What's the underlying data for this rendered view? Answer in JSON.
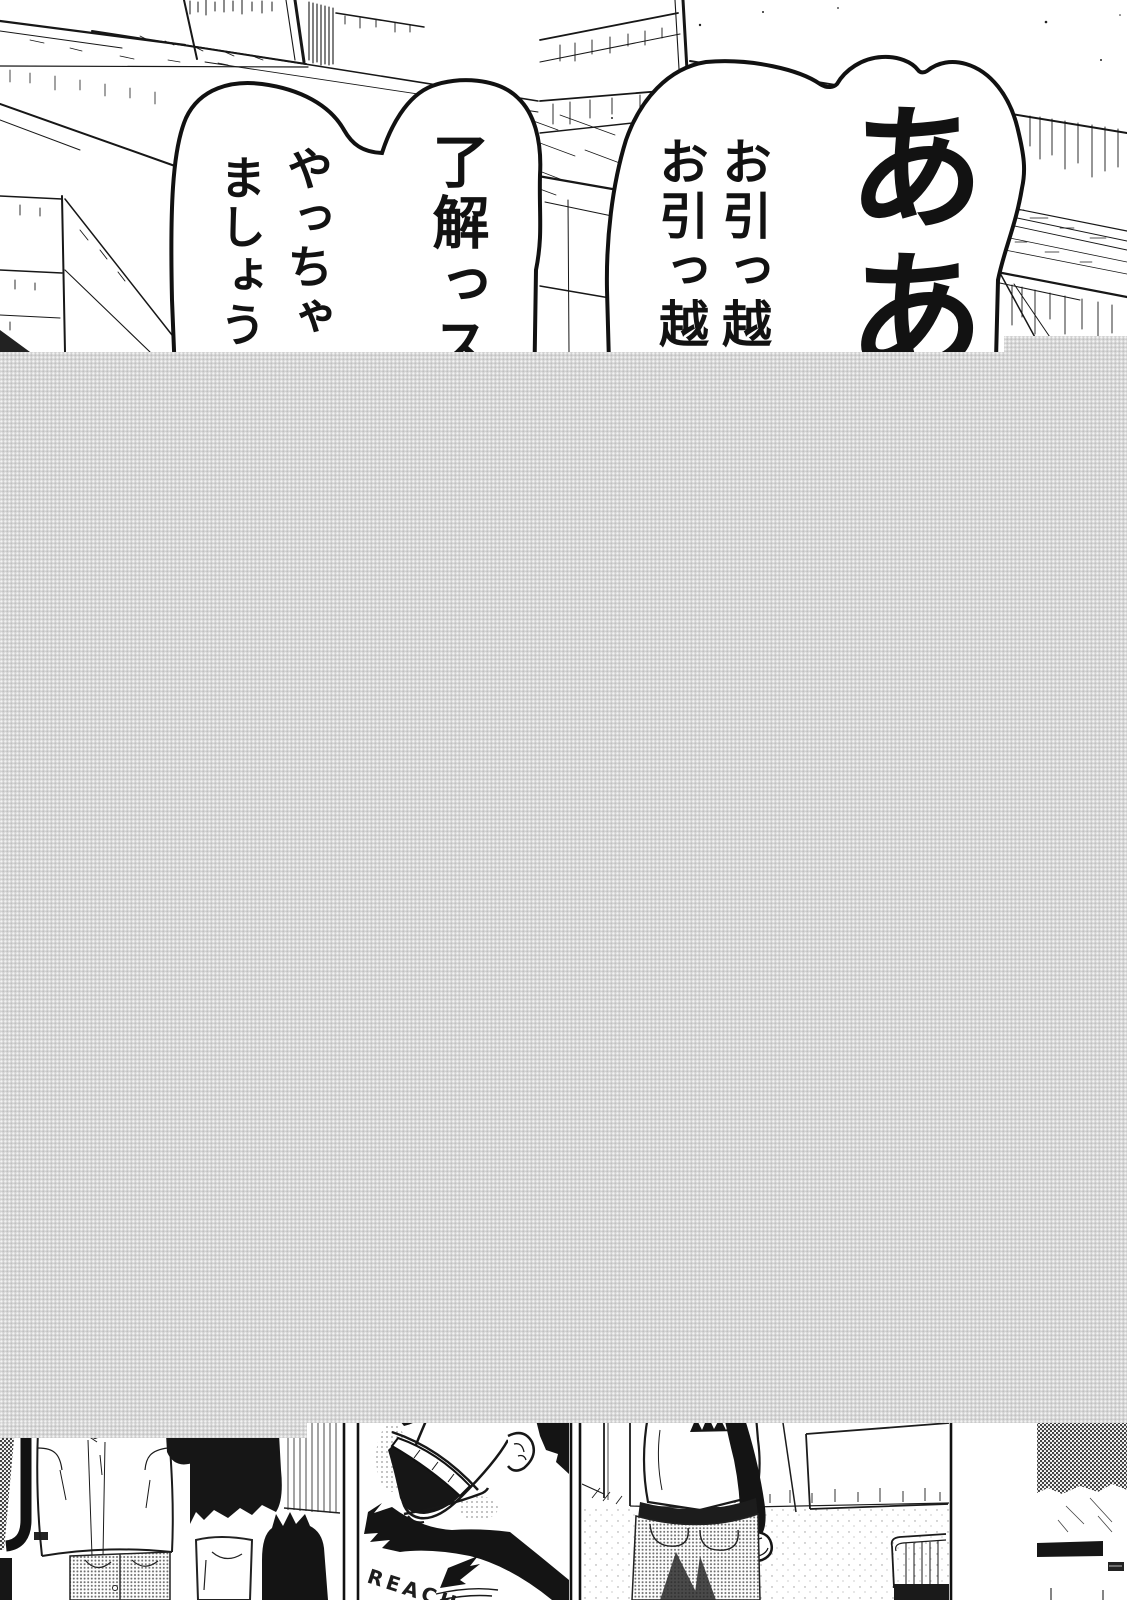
{
  "bubbles": {
    "right": {
      "shout": "ああ",
      "col1": "お引っ越",
      "col2": "お引っ越"
    },
    "left": {
      "col1": "了解っス",
      "col2": "やっちゃ",
      "col3": "ましょう"
    }
  },
  "bottom": {
    "shirt_text": "REACH"
  },
  "colors": {
    "placeholder_gray": "#d2d2d2",
    "ink": "#141414",
    "paper": "#ffffff"
  }
}
